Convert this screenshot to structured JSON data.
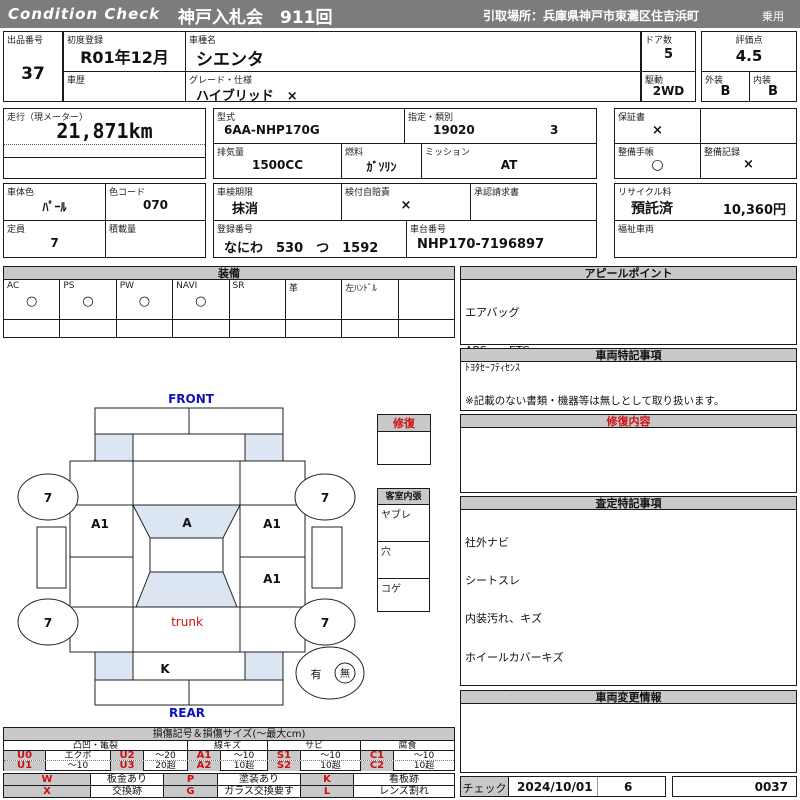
{
  "header": {
    "brand": "Condition  Check",
    "auction": "神戸入札会　911回",
    "pickup": "引取場所：兵庫県神戸市東灘区住吉浜町",
    "category": "乗用"
  },
  "info": {
    "lot": {
      "label": "出品番号",
      "value": "37"
    },
    "first_reg": {
      "label": "初度登録",
      "value": "R01年12月"
    },
    "history": {
      "label": "車歴",
      "value": ""
    },
    "model": {
      "label": "車種名",
      "value": "シエンタ"
    },
    "grade": {
      "label": "グレード・仕様",
      "value": "ハイブリッド　×"
    },
    "doors": {
      "label": "ドア数",
      "value": "5"
    },
    "drive": {
      "label": "駆動",
      "value": "2WD"
    },
    "score": {
      "label": "評価点",
      "value": "4.5"
    },
    "exterior": {
      "label": "外装",
      "value": "B"
    },
    "interior": {
      "label": "内装",
      "value": "B"
    },
    "mileage": {
      "label": "走行（現メーター）",
      "value": "21,871km"
    },
    "model_code": {
      "label": "型式",
      "value": "6AA-NHP170G"
    },
    "class": {
      "label": "指定・類別",
      "value1": "19020",
      "value2": "3"
    },
    "displacement": {
      "label": "排気量",
      "value": "1500CC"
    },
    "fuel": {
      "label": "燃料",
      "value": "ｶﾞｿﾘﾝ"
    },
    "mission": {
      "label": "ミッション",
      "value": "AT"
    },
    "warranty": {
      "label": "保証書",
      "value": "×"
    },
    "maint_book": {
      "label": "整備手帳",
      "value": "○"
    },
    "maint_record": {
      "label": "整備記録",
      "value": "×"
    },
    "body_color": {
      "label": "車体色",
      "value": "ﾊﾟｰﾙ"
    },
    "color_code": {
      "label": "色コード",
      "value": "070"
    },
    "capacity": {
      "label": "定員",
      "value": "7"
    },
    "load": {
      "label": "積載量",
      "value": ""
    },
    "inspection": {
      "label": "車検期限",
      "value": "抹消"
    },
    "insurance": {
      "label": "検付自賠責",
      "value": "×"
    },
    "approval": {
      "label": "承認請求書",
      "value": ""
    },
    "reg_no": {
      "label": "登録番号",
      "value": "なにわ　530　つ　1592"
    },
    "chassis": {
      "label": "車台番号",
      "value": "NHP170-7196897"
    },
    "recycle": {
      "label": "リサイクル料",
      "status": "預託済",
      "fee": "10,360円"
    },
    "welfare": {
      "label": "福祉車両",
      "value": ""
    }
  },
  "equipment": {
    "title": "装備",
    "items": [
      {
        "label": "AC",
        "value": "○"
      },
      {
        "label": "PS",
        "value": "○"
      },
      {
        "label": "PW",
        "value": "○"
      },
      {
        "label": "NAVI",
        "value": "○"
      },
      {
        "label": "SR",
        "value": ""
      },
      {
        "label": "革",
        "value": ""
      },
      {
        "label": "左ﾊﾝﾄﾞﾙ",
        "value": ""
      },
      {
        "label": "",
        "value": ""
      }
    ]
  },
  "appeal": {
    "title": "アピールポイント",
    "lines": [
      "エアバッグ",
      "ABS　　ETC",
      "プッシュスタート",
      "左側パワースライドドア",
      "バックカメラ付き"
    ]
  },
  "vehicle_notes": {
    "title": "車両特記事項",
    "line1": "ﾄﾖﾀｾｰﾌﾃｨｾﾝｽ",
    "footnote": "※記載のない書類・機器等は無しとして取り扱います。"
  },
  "repair_content": {
    "title": "修復内容"
  },
  "assessment_notes": {
    "title": "査定特記事項",
    "lines": [
      "社外ナビ",
      "シートスレ",
      "内装汚れ、キズ",
      "ホイールカバーキズ",
      "パンク修理キット有"
    ]
  },
  "change_info": {
    "title": "車両変更情報"
  },
  "check": {
    "label": "チェック",
    "date": "2024/10/01",
    "inspector": "6",
    "sheet_no": "0037"
  },
  "diagram": {
    "front_label": "FRONT",
    "rear_label": "REAR",
    "trunk_label": "trunk",
    "tire_fl": "7",
    "tire_fr": "7",
    "tire_rl": "7",
    "tire_rr": "7",
    "windshield_mark": "A",
    "left_front_door_mark": "A1",
    "right_front_door_mark": "A1",
    "right_rear_door_mark": "A1",
    "rear_panel_mark": "K",
    "spare_yes": "有",
    "spare_no": "無",
    "repair_box_title": "修復",
    "interior_box": {
      "title": "客室内張",
      "rows": [
        "ヤブレ",
        "穴",
        "コゲ"
      ]
    }
  },
  "damage_legend": {
    "title": "損傷記号＆損傷サイズ(～最大cm)",
    "groups": [
      "凸凹・亀裂",
      "線キズ",
      "サビ",
      "腐食"
    ],
    "rows": [
      [
        "U0",
        "エクボ",
        "U2",
        "～20",
        "A1",
        "～10",
        "S1",
        "～10",
        "C1",
        "～10"
      ],
      [
        "U1",
        "～10",
        "U3",
        "20超",
        "A2",
        "10超",
        "S2",
        "10超",
        "C2",
        "10超"
      ]
    ],
    "rows2": [
      [
        "W",
        "板金あり",
        "P",
        "塗装あり",
        "K",
        "看板跡"
      ],
      [
        "X",
        "交換跡",
        "G",
        "ガラス交換要す",
        "L",
        "レンズ割れ"
      ]
    ]
  },
  "colors": {
    "topbar_bg": "#7c7c7c",
    "section_header_bg": "#c9c9c9",
    "shade_blue": "#dce6f2",
    "accent_red": "#cc1111",
    "accent_blue": "#1111bb"
  }
}
